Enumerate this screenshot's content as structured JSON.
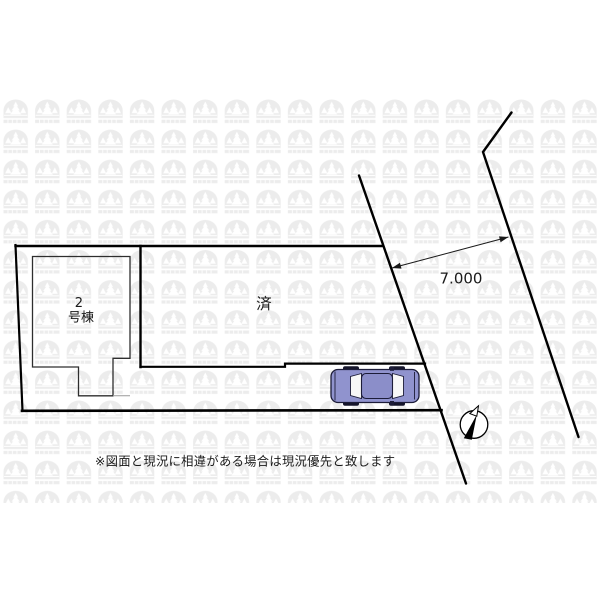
{
  "plan": {
    "building": {
      "label_top": "2",
      "label_bottom": "号棟"
    },
    "sold_label": "済",
    "road_width": "7.000",
    "disclaimer": "※図面と現況に相違がある場合は現況優先と致します",
    "colors": {
      "line": "#000000",
      "building_line": "#2e2e2e",
      "car_body": "#9093CE",
      "car_roof": "#8B8EC9",
      "car_outline": "#1c1c38",
      "watermark": "#ececec"
    }
  }
}
